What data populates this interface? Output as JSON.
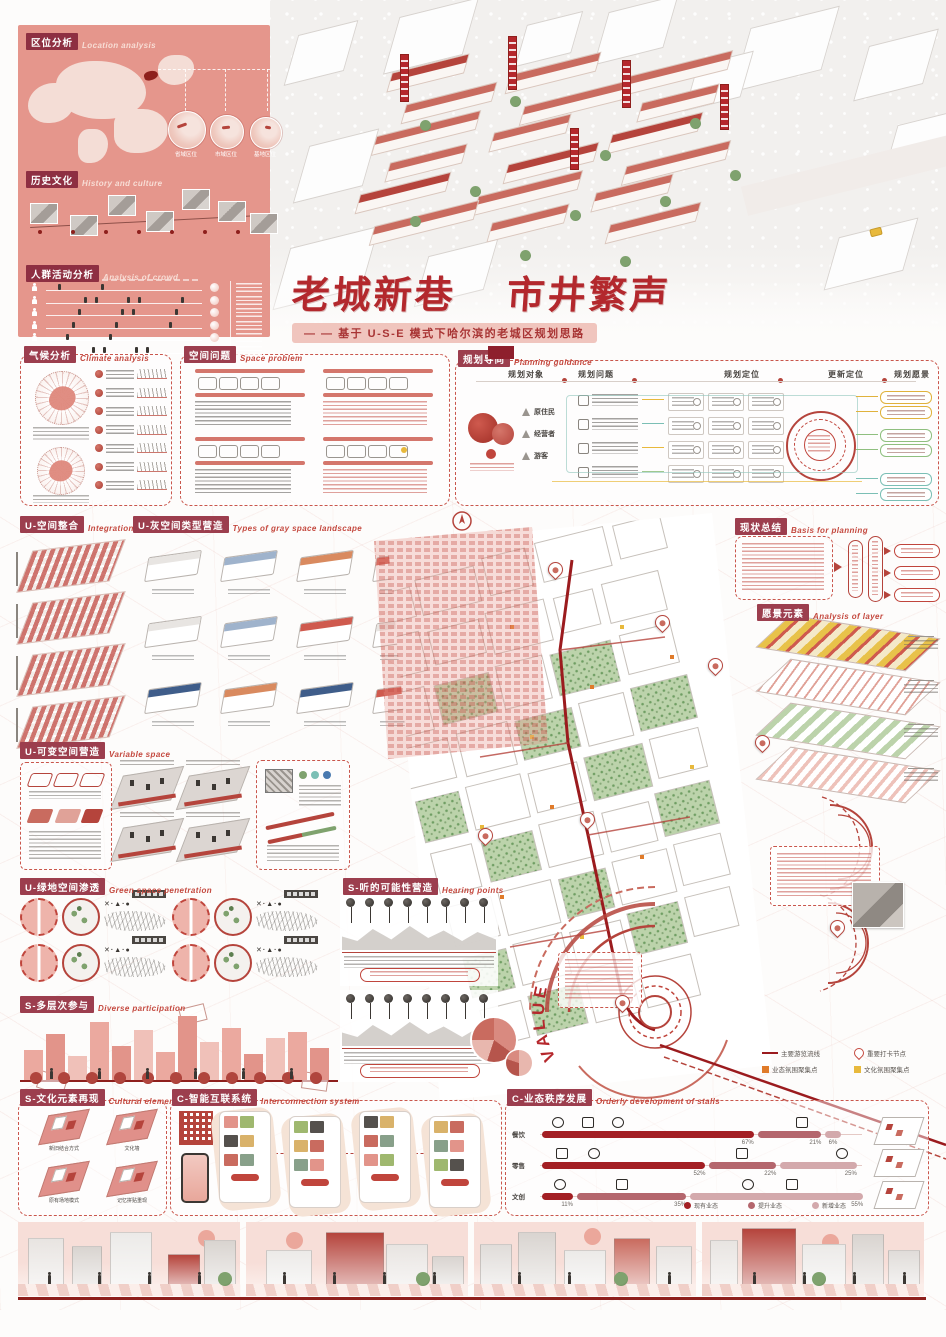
{
  "poster": {
    "title_part1": "老城新巷",
    "title_part2": "市井繁声",
    "subtitle": "— — 基于 U-S-E 模式下哈尔滨的老城区规划思路",
    "colors": {
      "maroon": "#9c3e4e",
      "red": "#c4483e",
      "salmon": "#e5968c",
      "dark_red": "#9b1b1e",
      "green": "#b7d0a6",
      "yellow": "#e8b93c",
      "teal": "#7bbfb5",
      "orange": "#e07b2a"
    }
  },
  "sections": {
    "location": {
      "zh": "区位分析",
      "en": "Location analysis"
    },
    "history": {
      "zh": "历史文化",
      "en": "History and culture"
    },
    "crowd": {
      "zh": "人群活动分析",
      "en": "Analysis of crowd"
    },
    "climate": {
      "zh": "气候分析",
      "en": "Climate analysis"
    },
    "space_problem": {
      "zh": "空间问题",
      "en": "Space problem"
    },
    "planning": {
      "zh": "规划导向",
      "en": "Planning guidance"
    },
    "integration": {
      "zh": "U-空间整合",
      "en": "Integration"
    },
    "gray_space": {
      "zh": "U-灰空间类型营造",
      "en": "Types of gray space landscape"
    },
    "basis": {
      "zh": "现状总结",
      "en": "Basis for planning"
    },
    "layers": {
      "zh": "愿景元素",
      "en": "Analysis of layer"
    },
    "variable": {
      "zh": "U-可变空间营造",
      "en": "Variable space"
    },
    "green": {
      "zh": "U-绿地空间渗透",
      "en": "Green space penetration"
    },
    "hearing": {
      "zh": "S-听的可能性营造",
      "en": "Hearing points"
    },
    "participation": {
      "zh": "S-多层次参与",
      "en": "Diverse participation"
    },
    "culture": {
      "zh": "S-文化元素再现",
      "en": "Cultural elements /appear"
    },
    "interconnect": {
      "zh": "C-智能互联系统",
      "en": "Interconnection system"
    },
    "stalls": {
      "zh": "C-业态秩序发展",
      "en": "Orderly development of stalls"
    }
  },
  "location": {
    "circle_labels": [
      "省域区位",
      "市域区位",
      "基地区位"
    ]
  },
  "planning": {
    "columns": [
      "规划对象",
      "规划问题",
      "规划定位",
      "更新定位",
      "规划愿景"
    ],
    "subjects": [
      "原住民",
      "经营者",
      "游客"
    ]
  },
  "map": {
    "value_label": "VALUE",
    "legend": [
      {
        "type": "line",
        "color": "#9b1b1e",
        "label": "主要游览流线"
      },
      {
        "type": "pin",
        "color": "#c4483e",
        "label": "重要打卡节点"
      },
      {
        "type": "square",
        "color": "#e07b2a",
        "label": "业态氛围聚集点"
      },
      {
        "type": "square",
        "color": "#e8b93c",
        "label": "文化氛围聚集点"
      }
    ]
  },
  "culture_items": [
    "新旧结合方式",
    "文化墙",
    "原有场地模式",
    "记忆拼贴重现"
  ],
  "gray_space_modules": {
    "roof_colors": [
      "#e8e5e2",
      "#9fb3cc",
      "#d98a5f",
      "#cf5a4e",
      "#e8e5e2",
      "#9fb3cc",
      "#cf5a4e",
      "#e8e5e2",
      "#3f5d8a",
      "#d98a5f",
      "#3f5d8a",
      "#cf5a4e"
    ]
  },
  "chart_data": {
    "type": "bar",
    "title": "业态秩序发展",
    "rows": [
      {
        "label": "餐饮",
        "values": [
          67,
          21,
          6
        ]
      },
      {
        "label": "零售",
        "values": [
          52,
          22,
          25
        ]
      },
      {
        "label": "文创",
        "values": [
          11,
          35,
          55
        ]
      }
    ],
    "unit": "%",
    "legend": [
      "现有业态",
      "提升业态",
      "新增业态"
    ],
    "colors": [
      "#a31f24",
      "#b4666d",
      "#d3a9ac"
    ],
    "xlim": [
      0,
      100
    ]
  }
}
